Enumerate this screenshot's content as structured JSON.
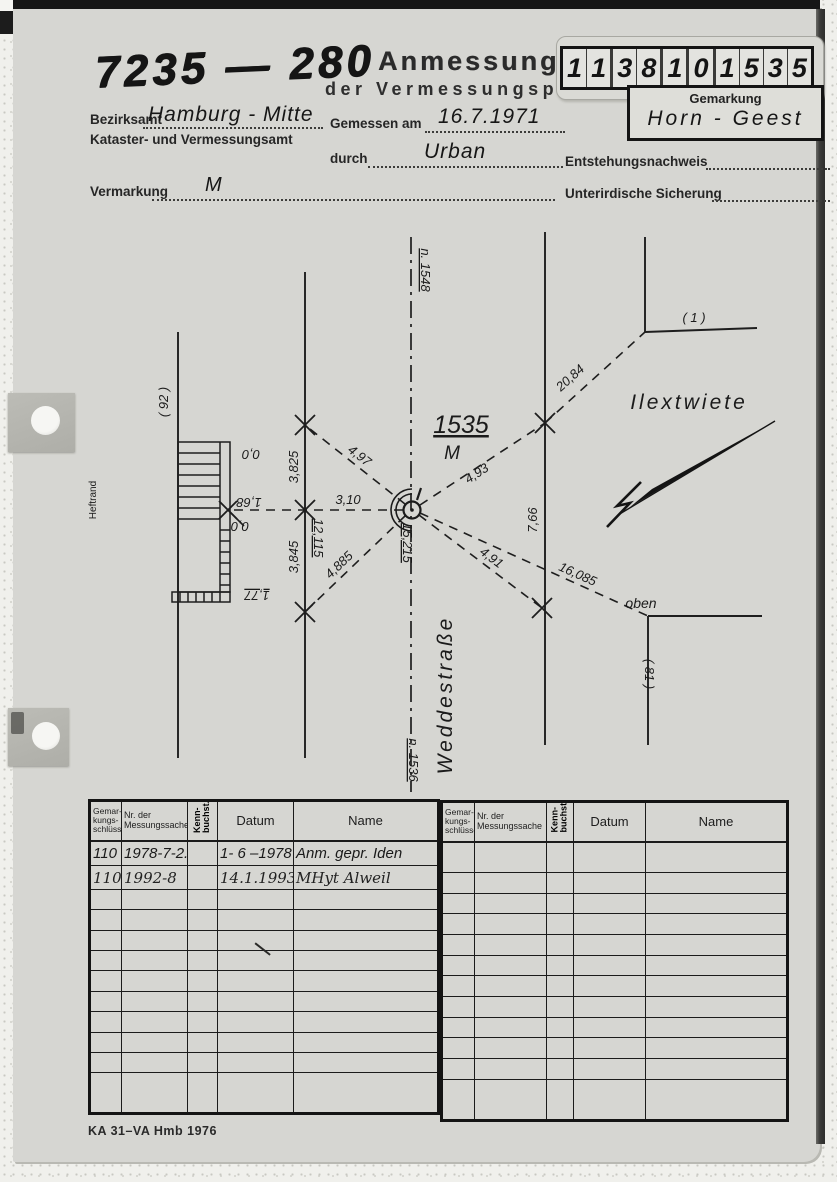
{
  "document": {
    "file_number": "7235 — 280",
    "title": "Anmessung",
    "subtitle": "der Vermessungspunkte",
    "form_code": "KA 31–VA Hmb 1976"
  },
  "point_id": {
    "digits": [
      "1",
      "1",
      "3",
      "8",
      "1",
      "0",
      "1",
      "5",
      "3",
      "5"
    ]
  },
  "gemarkung": {
    "label": "Gemarkung",
    "value": "Horn - Geest"
  },
  "fields": {
    "bezirksamt_label": "Bezirksamt",
    "bezirksamt_value": "Hamburg - Mitte",
    "amt_label": "Kataster- und Vermessungsamt",
    "gemessen_label": "Gemessen am",
    "gemessen_value": "16.7.1971",
    "durch_label": "durch",
    "durch_value": "Urban",
    "entstehung_label": "Entstehungsnachweis",
    "vermarkung_label": "Vermarkung",
    "vermarkung_value": "M",
    "sicherung_label": "Unterirdische Sicherung"
  },
  "sketch": {
    "point_number": "1535",
    "point_mark": "M",
    "street": "Weddestraße",
    "street2": "Ilextwiete",
    "margin_label": "Heftrand",
    "labels": {
      "line_92": "( 92 )",
      "line_1": "( 1 )",
      "line_81": "( 81 )",
      "oben": "oben",
      "n1548": "n. 1548",
      "n1536": "n. 1536",
      "d2084": "20,84",
      "d497": "4,97",
      "d493": "4,93",
      "d310": "3,10",
      "d4885": "4,885",
      "d491": "4,91",
      "d16085": "16,085",
      "d766": "7,66",
      "d3825": "3,825",
      "d3845": "3,845",
      "d12115": "12,115",
      "d15215": "15,215",
      "d168": "1,68",
      "d00a": "0,0",
      "d00b": "0,0",
      "d177": "1,77"
    }
  },
  "tables": {
    "headers": {
      "col1": [
        "Gemar-",
        "kungs-",
        "schlüssel"
      ],
      "col2": [
        "Nr. der",
        "Messungssache"
      ],
      "col3": [
        "Kenn-",
        "buchst."
      ],
      "col4": "Datum",
      "col5": "Name"
    },
    "left_rows": [
      {
        "key": "110",
        "nr": "1978-7-2.13",
        "kenn": "",
        "datum": "1- 6 –1978",
        "name": "Anm.  gepr.  Iden"
      },
      {
        "key": "110",
        "nr": "1992-8",
        "kenn": "",
        "datum": "14.1.1993",
        "name": "MHyt  Alweil"
      }
    ]
  }
}
